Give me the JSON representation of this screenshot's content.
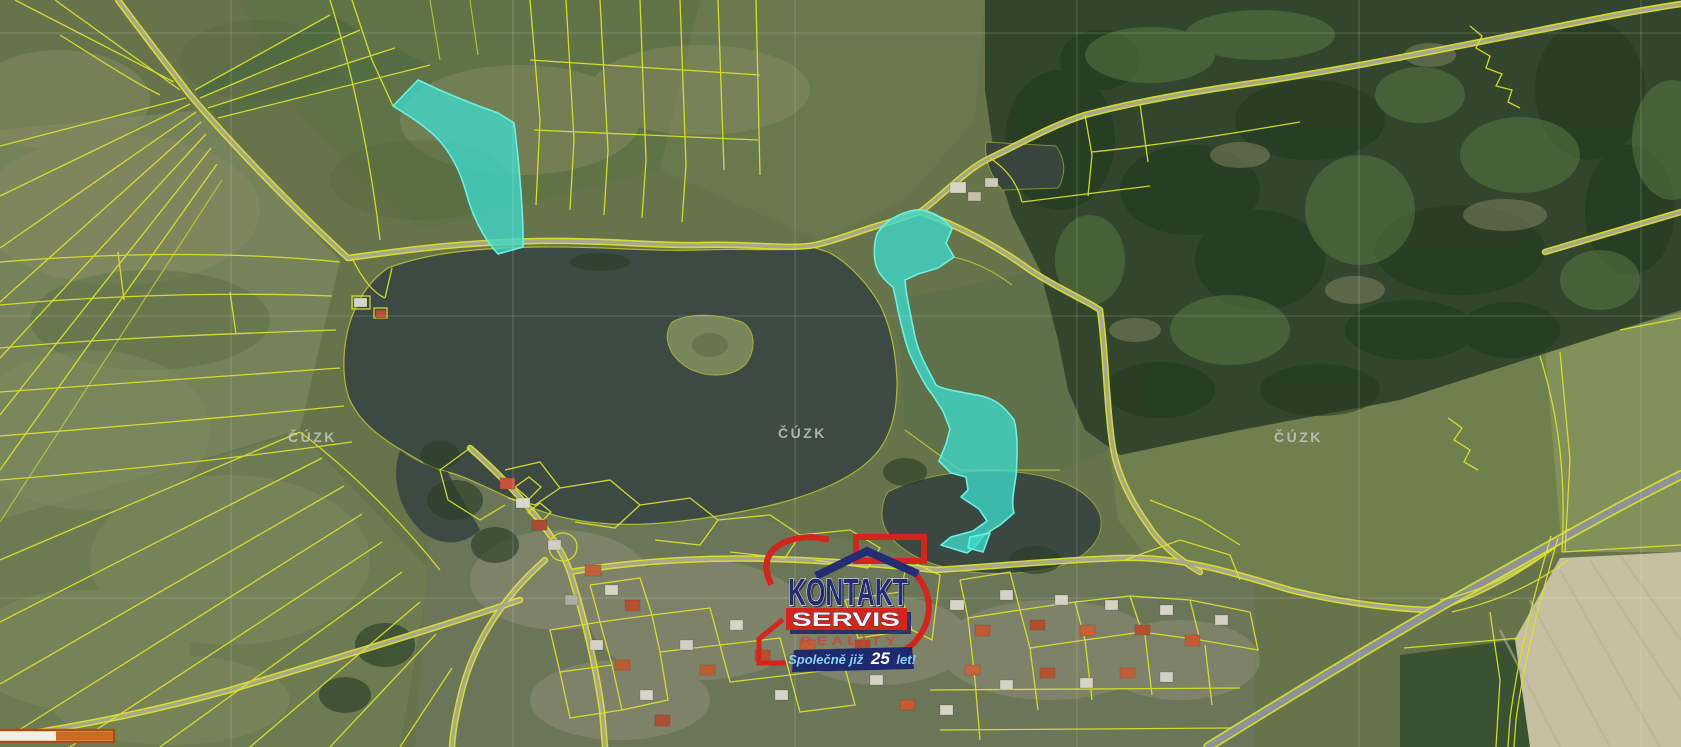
{
  "map": {
    "source_watermark": "ČÚZK"
  },
  "overlay_logo": {
    "brand_line1": "KONTAKT",
    "brand_line2": "SERVIS",
    "brand_line3": "R E A L I T Y",
    "tagline_prefix": "Společně již",
    "tagline_number": "25",
    "tagline_suffix": "let!"
  },
  "colors": {
    "parcel_line": "#dde32b",
    "highlight_parcel": "#3ed8cb",
    "water": "#3d4a43",
    "forest": "#31462c",
    "logo_red": "#d2251c",
    "logo_navy": "#232d72",
    "tagline_text": "#86d3f2",
    "scalebar_orange": "#c96a1e"
  }
}
